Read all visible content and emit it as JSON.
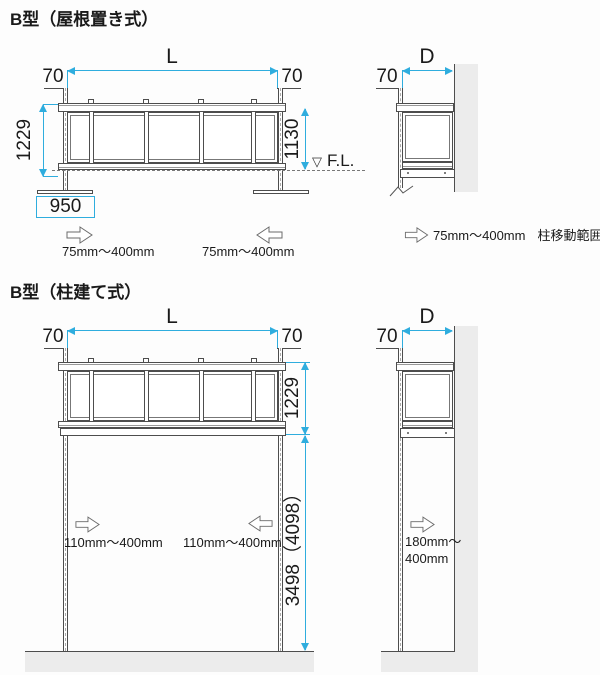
{
  "diagram": {
    "kind": "technical-drawing",
    "sections": [
      {
        "title": "B型（屋根置き式）",
        "front_view": {
          "length_label": "L",
          "end_offset_left": "70",
          "end_offset_right": "70",
          "total_height": "1229",
          "height_above_floor": "1130",
          "floor_level_label": "F.L.",
          "base_width": "950",
          "post_range_left": "75mm～400mm",
          "post_range_right": "75mm～400mm"
        },
        "side_view": {
          "depth_label": "D",
          "end_offset": "70",
          "post_range": "75mm～400mm",
          "post_range_note": "柱移動範囲"
        }
      },
      {
        "title": "B型（柱建て式）",
        "front_view": {
          "length_label": "L",
          "end_offset_left": "70",
          "end_offset_right": "70",
          "rail_height": "1229",
          "post_height": "3498（4098）",
          "post_range_left": "110mm～400mm",
          "post_range_right": "110mm～400mm"
        },
        "side_view": {
          "depth_label": "D",
          "end_offset": "70",
          "post_range_line1": "180mm～",
          "post_range_line2": "400mm"
        }
      }
    ]
  },
  "icons": {
    "floor_level_marker": "▽"
  },
  "colors": {
    "dimension_accent": "#2fadde",
    "structure_line": "#4d4d4d",
    "wall_fill": "#ececec",
    "text": "#1a1a1a",
    "background": "#fdfdfd"
  }
}
